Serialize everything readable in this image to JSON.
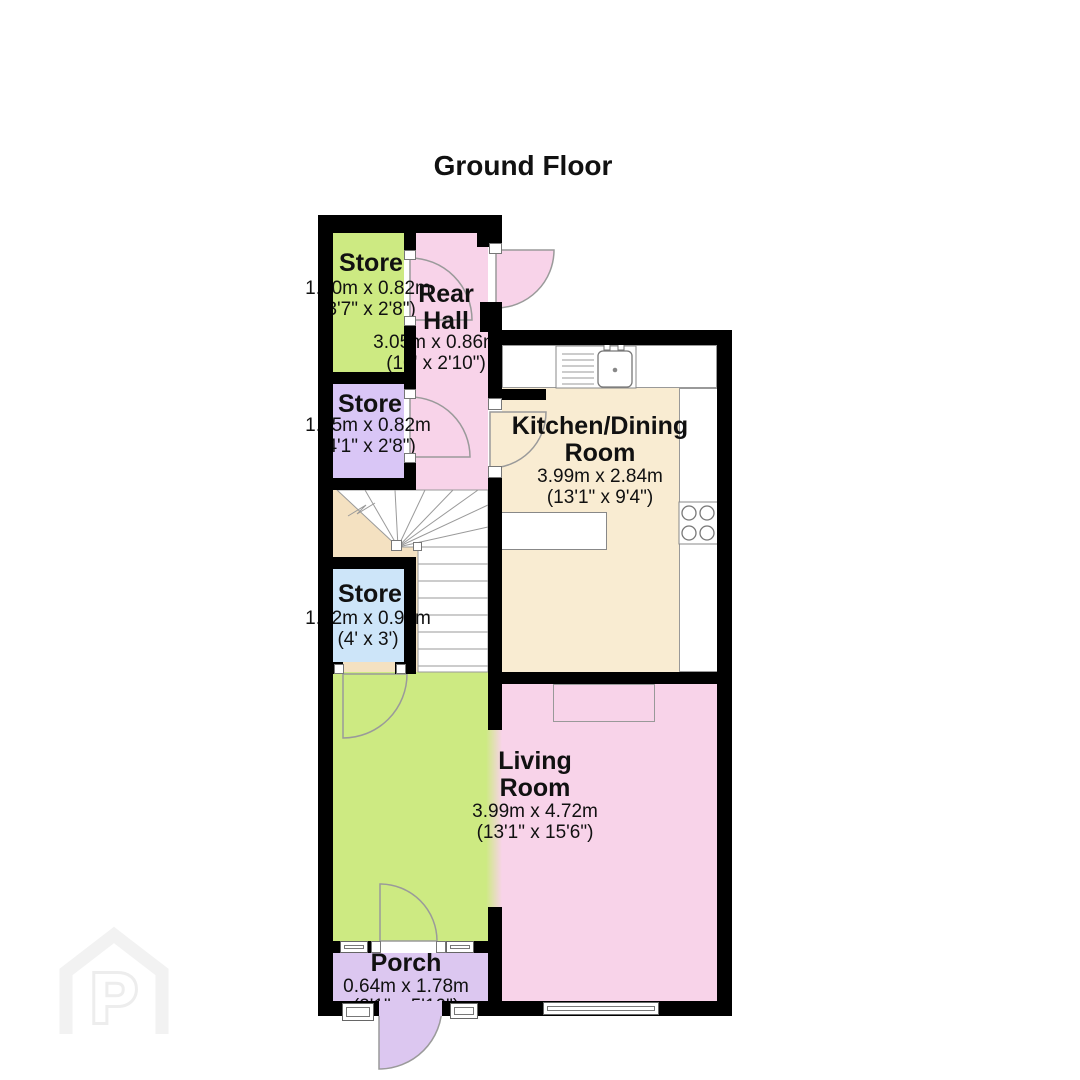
{
  "title": "Ground Floor",
  "watermark_letter": "P",
  "rooms": {
    "store_top": {
      "name": "Store",
      "metric": "1.10m x 0.82m",
      "imperial": "(3'7\" x 2'8\")"
    },
    "rear_hall": {
      "line1": "Rear",
      "line2": "Hall",
      "metric": "3.05m x 0.86m",
      "imperial": "(10' x 2'10\")"
    },
    "store_mid": {
      "name": "Store",
      "metric": "1.25m x 0.82m",
      "imperial": "(4'1\" x 2'8\")"
    },
    "kitchen_dining": {
      "line1": "Kitchen/Dining",
      "line2": "Room",
      "metric": "3.99m x 2.84m",
      "imperial": "(13'1\" x 9'4\")"
    },
    "store_stairs": {
      "name": "Store",
      "metric": "1.22m x 0.91m",
      "imperial": "(4' x 3')"
    },
    "living_room": {
      "line1": "Living",
      "line2": "Room",
      "metric": "3.99m x 4.72m",
      "imperial": "(13'1\" x 15'6\")"
    },
    "porch": {
      "name": "Porch",
      "metric": "0.64m x 1.78m",
      "imperial": "(2'1\" x 5'10\")"
    }
  },
  "colors": {
    "wall": "#000000",
    "room-green": "#cdea82",
    "room-pink": "#f8d3e9",
    "room-lavender": "#d9c6f6",
    "room-blue": "#cde5f9",
    "room-beige": "#f4e1c1",
    "room-cream": "#f9ecd2",
    "room-porch": "#dcc7f0",
    "line": "#9a9a9a",
    "text": "#111111",
    "watermark": "#f2f2f2"
  }
}
